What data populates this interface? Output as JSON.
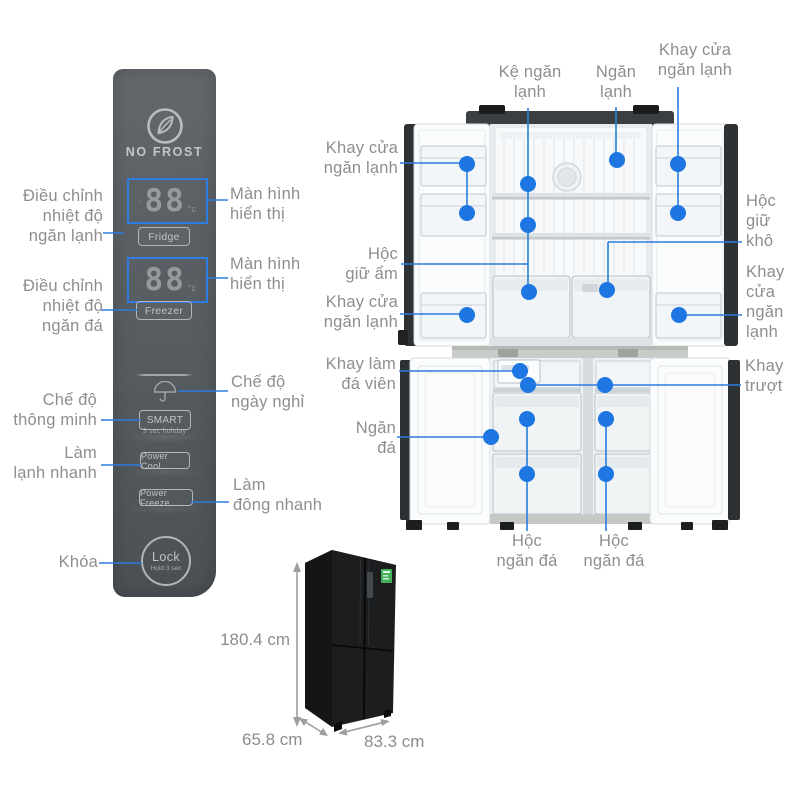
{
  "colors": {
    "dot_blue": "#1d76e2",
    "line_blue": "#2b7ce0",
    "label_gray": "#8e8e8e",
    "panel_gray": "#585d62",
    "energy_label_green": "#43b05c"
  },
  "control_panel": {
    "brand": "NO FROST",
    "displays": [
      {
        "value": "88",
        "unit": "°c"
      },
      {
        "value": "88",
        "unit": "°c"
      }
    ],
    "buttons": {
      "fridge": "Fridge",
      "freezer": "Freezer",
      "smart": "SMART",
      "smart_sub": "3 sec holiday",
      "power_cool": "Power Cool",
      "power_freeze": "Power Freeze",
      "lock": "Lock",
      "lock_sub": "Hold 3 sec"
    }
  },
  "panel_callouts": {
    "fridge_temp": "Điều chỉnh\nnhiệt độ\nngăn lạnh",
    "display_top": "Màn hình\nhiển thị",
    "freezer_temp": "Điều chỉnh\nnhiệt độ\nngăn đá",
    "display_bottom": "Màn hình\nhiển thị",
    "holiday": "Chế độ\nngày nghỉ",
    "smart": "Chế độ\nthông minh",
    "quick_cool": "Làm\nlạnh nhanh",
    "quick_freeze": "Làm\nđông nhanh",
    "lock": "Khóa"
  },
  "fridge_callouts": {
    "shelf": "Kệ ngăn\nlạnh",
    "fridge_compartment": "Ngăn\nlạnh",
    "door_tray_top_right": "Khay cửa\nngăn lạnh",
    "door_tray_left": "Khay cửa\nngăn lạnh",
    "humid_box": "Hộc\ngiữ ẩm",
    "door_tray_left_lower": "Khay cửa\nngăn lạnh",
    "ice_tray": "Khay làm\nđá viên",
    "freezer_compartment": "Ngăn\nđá",
    "dry_box": "Hộc\ngiữ\nkhô",
    "door_tray_right": "Khay\ncửa\nngăn\nlạnh",
    "slide_tray": "Khay\ntrượt",
    "freezer_box_left": "Hộc\nngăn đá",
    "freezer_box_right": "Hộc\nngăn đá"
  },
  "dimensions": {
    "height": "180.4 cm",
    "depth": "65.8 cm",
    "width": "83.3 cm"
  }
}
